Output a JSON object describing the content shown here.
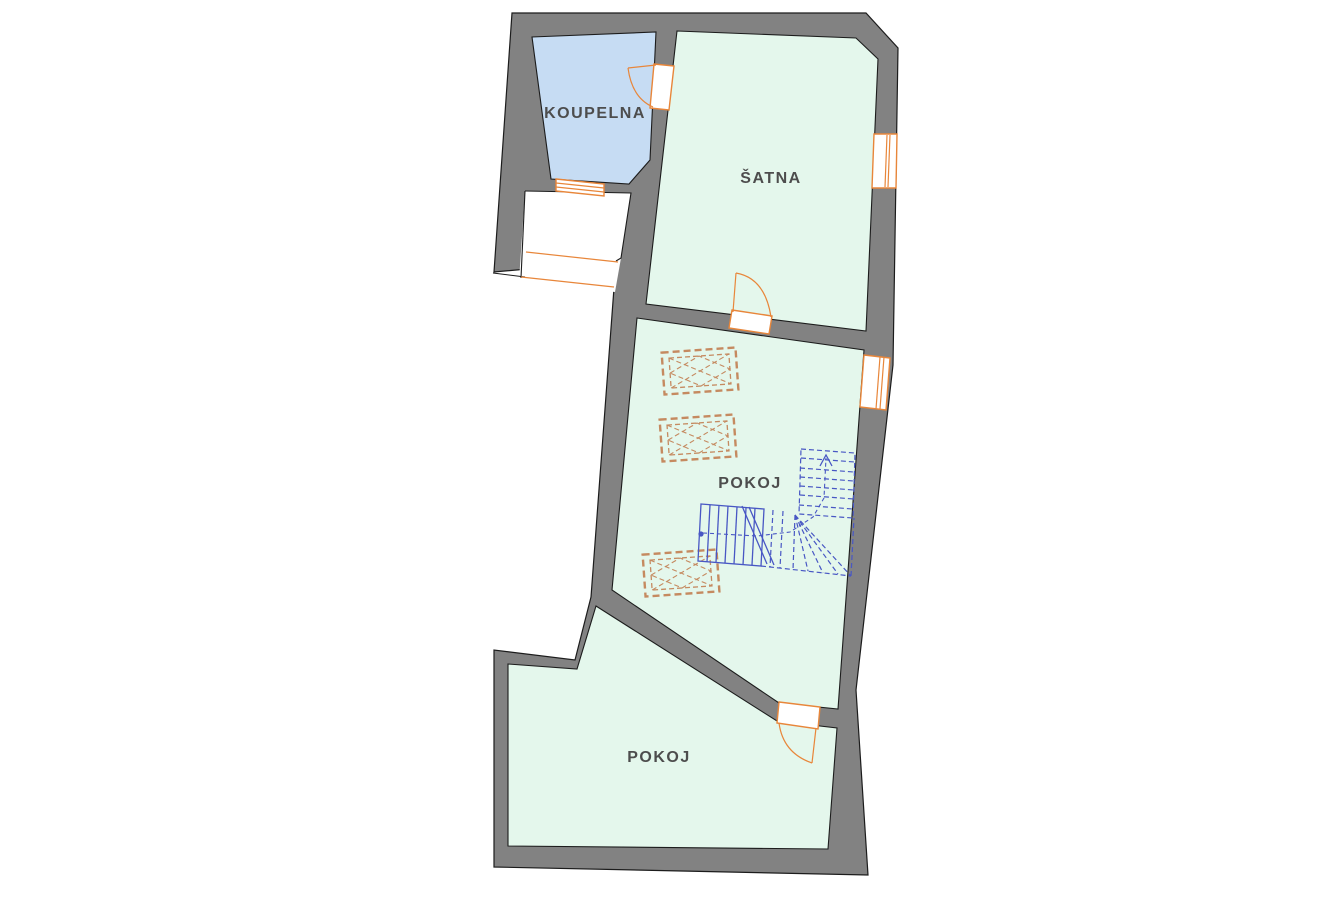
{
  "plan": {
    "type": "floor-plan",
    "rooms": [
      {
        "id": "koupelna",
        "label": "KOUPELNA"
      },
      {
        "id": "satna",
        "label": "ŠATNA"
      },
      {
        "id": "pokoj-middle",
        "label": "POKOJ"
      },
      {
        "id": "pokoj-bottom",
        "label": "POKOJ"
      }
    ],
    "features": {
      "doors": 3,
      "windows": 3,
      "skylights": 3,
      "staircase": "winder stair with lower solid flight and upper dashed flight"
    }
  },
  "colors": {
    "canvas-white": "#ffffff",
    "wall-fill": "#828282",
    "wall-outline": "#1c1c1c",
    "room-green": "#e4f7ec",
    "room-blue": "#c6dcf3",
    "opening-orange": "#e8863a",
    "skylight-orange": "#c58a60",
    "stair-blue": "#4857c4",
    "label-gray": "#4d4d4d"
  }
}
